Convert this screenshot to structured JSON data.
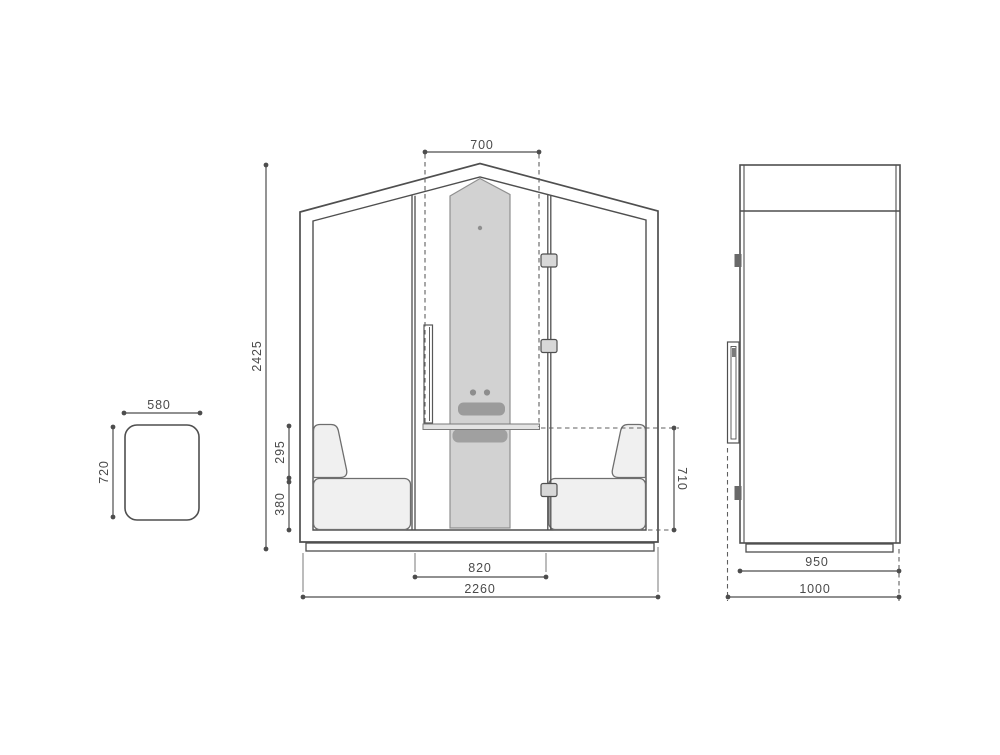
{
  "page": {
    "background": "#ffffff"
  },
  "colors": {
    "line": "#4f4f4f",
    "text": "#4a4a4a",
    "panel_gray": "#d2d2d2",
    "accent_gray": "#9b9b9b",
    "tray_gray": "#a0a0a0",
    "cushion_gray": "#f0f0f0",
    "hinge_gray": "#d8d8d8",
    "dark_hinge_gray": "#696969"
  },
  "views": {
    "stool_top": {
      "width_mm": "580",
      "depth_mm": "720"
    },
    "front": {
      "door_opening_width_mm": "700",
      "overall_height_mm": "2425",
      "backrest_height_mm": "295",
      "seat_height_mm": "380",
      "table_height_mm": "710",
      "door_width_mm": "820",
      "overall_width_mm": "2260"
    },
    "side": {
      "body_depth_mm": "950",
      "overall_depth_mm": "1000"
    }
  }
}
